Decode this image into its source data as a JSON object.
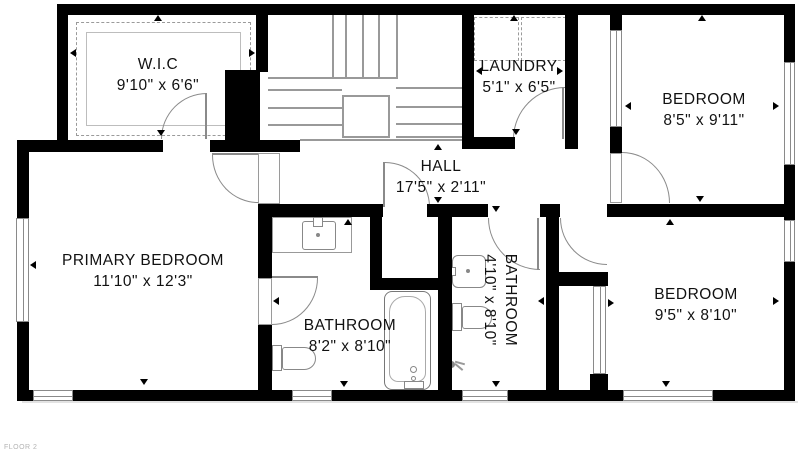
{
  "floor_label": "FLOOR 2",
  "rooms": {
    "wic": {
      "name": "W.I.C",
      "dims": "9'10\" x 6'6\""
    },
    "laundry": {
      "name": "LAUNDRY",
      "dims": "5'1\" x 6'5\""
    },
    "bedroom_tr": {
      "name": "BEDROOM",
      "dims": "8'5\" x 9'11\""
    },
    "hall": {
      "name": "HALL",
      "dims": "17'5\" x 2'11\""
    },
    "primary": {
      "name": "PRIMARY BEDROOM",
      "dims": "11'10\" x 12'3\""
    },
    "bath_main": {
      "name": "BATHROOM",
      "dims": "8'2\" x 8'10\""
    },
    "bath_small": {
      "name": "BATHROOM",
      "dims": "4'10\" x 8'10\""
    },
    "bedroom_br": {
      "name": "BEDROOM",
      "dims": "9'5\" x 8'10\""
    }
  },
  "colors": {
    "wall": "#000000",
    "line": "#8a8a8a",
    "floor_label": "#b3b3b3"
  }
}
